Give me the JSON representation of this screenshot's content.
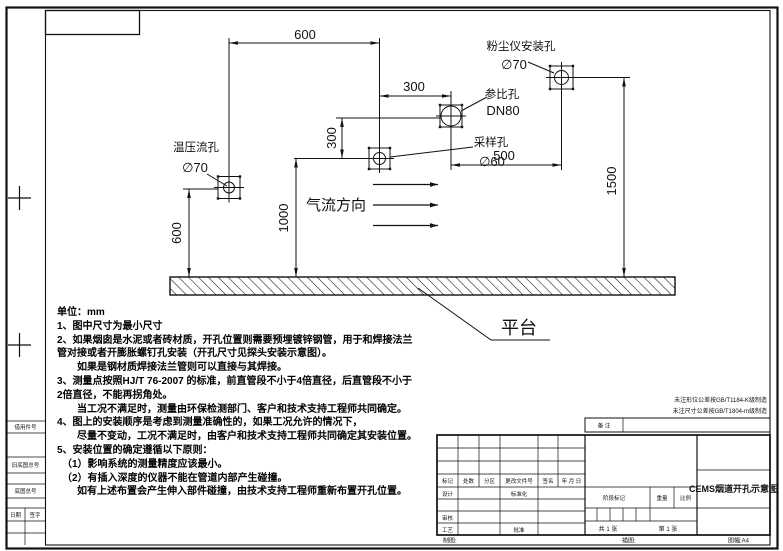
{
  "sheet": {
    "paper_size_label": "图幅:A4",
    "tolerance_note_1": "未注形位公差按GB/T1184-K级制造",
    "tolerance_note_2": "未注尺寸公差按GB/T1804-m级制造"
  },
  "border_fields": {
    "field_1": "借用件号",
    "field_2": "旧底图总号",
    "field_3": "底图总号",
    "date_label": "日期",
    "sign_label": "签字"
  },
  "drawing": {
    "flow_direction_label": "气流方向",
    "platform_label": "平台",
    "holes": {
      "temp_pressure_flow": {
        "name": "温压流孔",
        "size": "∅70"
      },
      "sampling": {
        "name": "采样孔",
        "size": "∅60"
      },
      "reference": {
        "name": "参比孔",
        "size": "DN80"
      },
      "dust_meter": {
        "name": "粉尘仪安装孔",
        "size": "∅70"
      }
    },
    "dimensions": {
      "top_span": "600",
      "mid_span": "300",
      "vertical_offset": "300",
      "right_span": "500",
      "sampling_height": "1000",
      "temp_hole_height": "600",
      "dust_hole_height": "1500"
    }
  },
  "notes": {
    "unit_line": "单位：mm",
    "lines": [
      "1、图中尺寸为最小尺寸",
      "2、如果烟囱是水泥或者砖材质，开孔位置则需要预埋镀锌钢管，用于和焊接法兰",
      "管对接或者开膨胀螺钉孔安装（开孔尺寸见探头安装示意图）。",
      "　　如果是钢材质焊接法兰管则可以直接与其焊接。",
      "3、测量点按照HJ/T 76-2007 的标准，前直管段不小于4倍直径，后直管段不小于",
      "2倍直径，不能再拐角处。",
      "　　当工况不满足时，测量由环保检测部门、客户和技术支持工程师共同确定。",
      "4、图上的安装顺序是考虑到测量准确性的，如果工况允许的情况下，",
      "　　尽量不变动，工况不满足时，由客户和技术支持工程师共同确定其安装位置。",
      "5、安装位置的确定遵循以下原则：",
      "　（1）影响系统的测量精度应该最小。",
      "　（2）有插入深度的仪器不能在管道内部产生碰撞。",
      "　　如有上述布置会产生伸入部件碰撞，由技术支持工程师重新布置开孔位置。"
    ]
  },
  "title_block": {
    "remark_label": "备 注",
    "mark_label": "标记",
    "count_label": "处数",
    "zone_label": "分区",
    "doc_no_label": "更改文件号",
    "signature_label": "签名",
    "date_label": "年 月 日",
    "design_label": "设计",
    "standardization_label": "标准化",
    "check_label": "审核",
    "process_label": "工艺",
    "approve_label": "批准",
    "stage_mark_label": "阶段标记",
    "weight_label": "重量",
    "scale_label": "比例",
    "sheet_total": "共 1 张",
    "sheet_number": "第 1 张",
    "drawing_title": "CEMS烟道开孔示意图",
    "draft_label": "制图:",
    "trace_label": "描图:"
  }
}
